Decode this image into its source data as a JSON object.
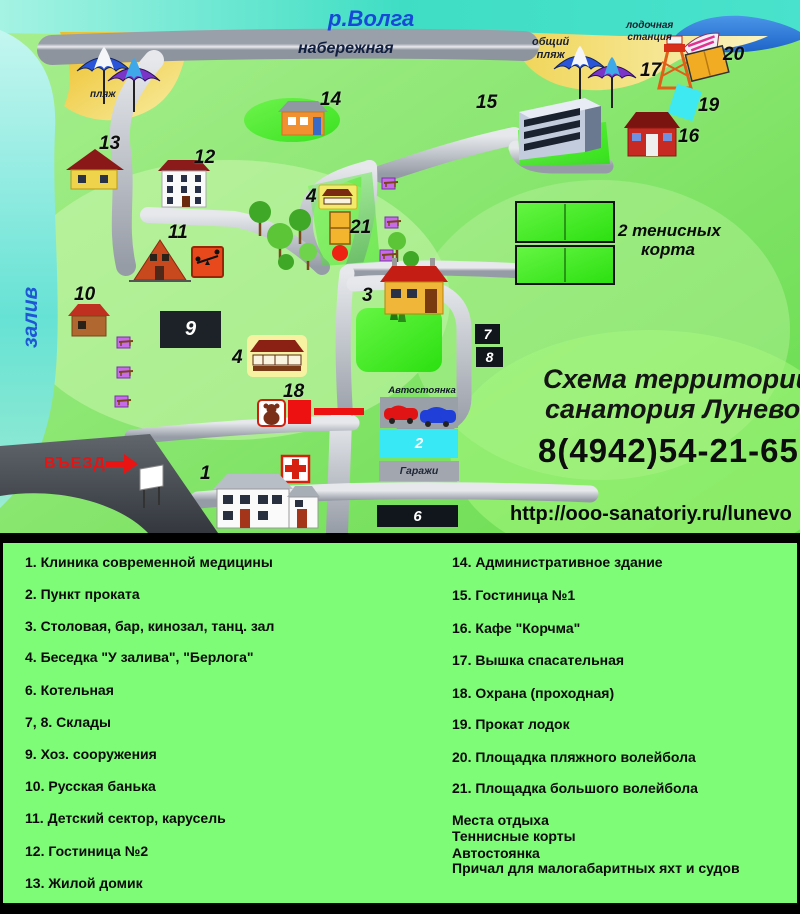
{
  "map": {
    "labels": {
      "river": "р.Волга",
      "embankment": "набережная",
      "beach": "пляж",
      "public_beach_line1": "общий",
      "public_beach_line2": "пляж",
      "boat_station_line1": "лодочная",
      "boat_station_line2": "станция",
      "bay": "залив",
      "entrance": "ВЪЕЗД",
      "parking": "Автостоянка",
      "garages": "Гаражи",
      "tennis_line1": "2 тенисных",
      "tennis_line2": "корта"
    },
    "numbers": {
      "n1": "1",
      "n2": "2",
      "n3": "3",
      "n4": "4",
      "n6": "6",
      "n7": "7",
      "n8": "8",
      "n9": "9",
      "n10": "10",
      "n11": "11",
      "n12": "12",
      "n13": "13",
      "n14": "14",
      "n15": "15",
      "n16": "16",
      "n17": "17",
      "n18": "18",
      "n19": "19",
      "n20": "20",
      "n21": "21"
    },
    "info": {
      "title_line1": "Схема территории",
      "title_line2": "санатория Лунево",
      "phone": "8(4942)54-21-65",
      "url": "http://ooo-sanatoriy.ru/lunevo"
    }
  },
  "legend": {
    "left": [
      "1. Клиника современной медицины",
      "2. Пункт проката",
      "3. Столовая, бар, кинозал, танц. зал",
      "4. Беседка  \"У залива\", \"Берлога\"",
      "6. Котельная",
      "7, 8. Склады",
      "9. Хоз. сооружения",
      "10. Русская банька",
      "11. Детский сектор, карусель",
      "12. Гостиница №2",
      "13. Жилой домик"
    ],
    "right": [
      "14. Административное здание",
      "15. Гостиница №1",
      "16. Кафе \"Корчма\"",
      "17. Вышка спасательная",
      "18. Охрана (проходная)",
      "19. Прокат лодок",
      "20. Площадка пляжного волейбола",
      "21. Площадка большого волейбола"
    ],
    "extra": [
      "Места отдыха",
      "Теннисные корты",
      "Автостоянка",
      "Причал для малогабаритных яхт и судов"
    ]
  },
  "colors": {
    "water_teal": "#43DFC6",
    "bay_blue": "#2E7FD6",
    "land_green": "#7FE35F",
    "bright_green": "#44EE22",
    "legend_bg": "#7EFB77",
    "road_gray": "#AEB4BC",
    "dark_road": "#4A5055",
    "beach_yellow": "#F2CC33",
    "accent_red": "#EE1111"
  }
}
